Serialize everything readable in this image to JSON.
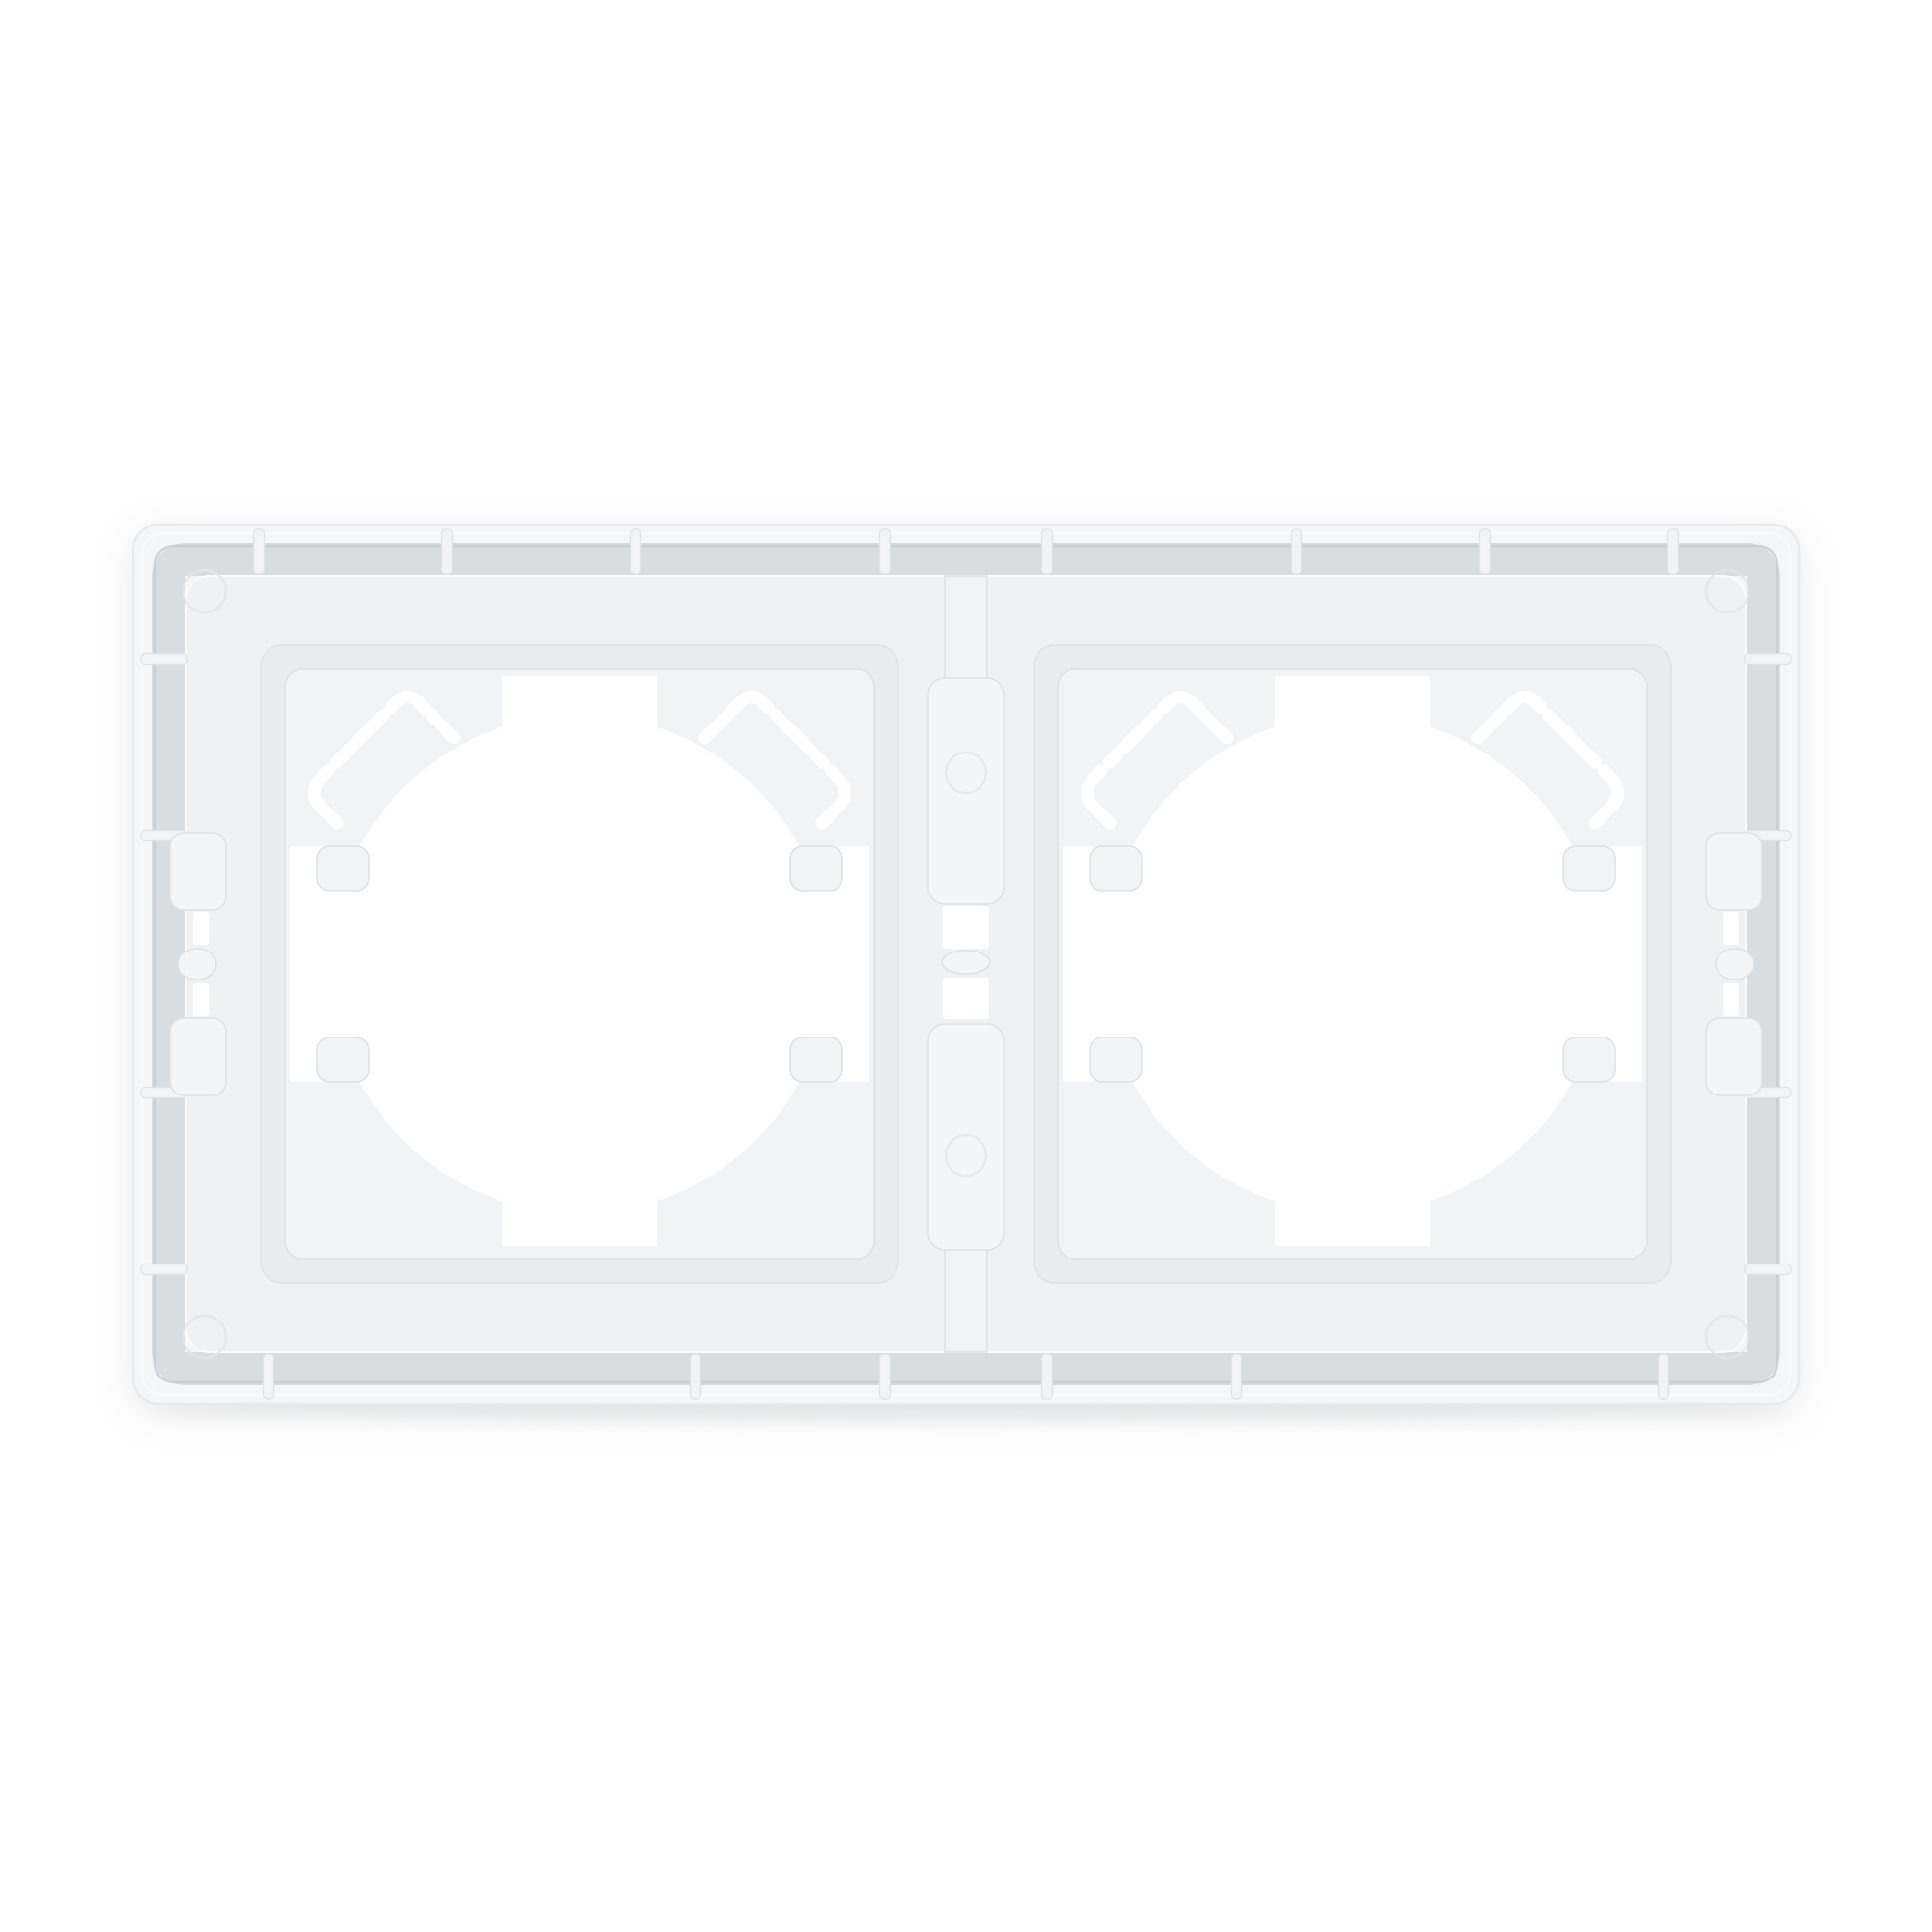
{
  "meta": {
    "description": "Rear view of a white plastic two-gang wall socket frame (surround back plate) centered on a plain white background",
    "alt": "Back side of a white double socket surround frame"
  },
  "object": {
    "type": "socket-frame-back-plate",
    "gangs": 2,
    "finish": "matte white plastic",
    "orientation": "horizontal"
  },
  "colors": {
    "bg": "#ffffff",
    "cut": "#ffffff",
    "wall": "#f5f6f7",
    "wallEdge": "#e8eaec",
    "groove": "#dadde0",
    "grooveDark": "#c8cccf",
    "plateau": "#f0f1f3",
    "recess": "#e9ebed",
    "plate": "#f2f3f5",
    "plateEdge": "#dee1e3",
    "rib": "#f2f3f4",
    "line": "#dfe2e4",
    "hi": "#fafbfc",
    "tab": "#f4f5f7",
    "bossLine": "#e4e6e8",
    "contact": "#e7e9ea"
  }
}
